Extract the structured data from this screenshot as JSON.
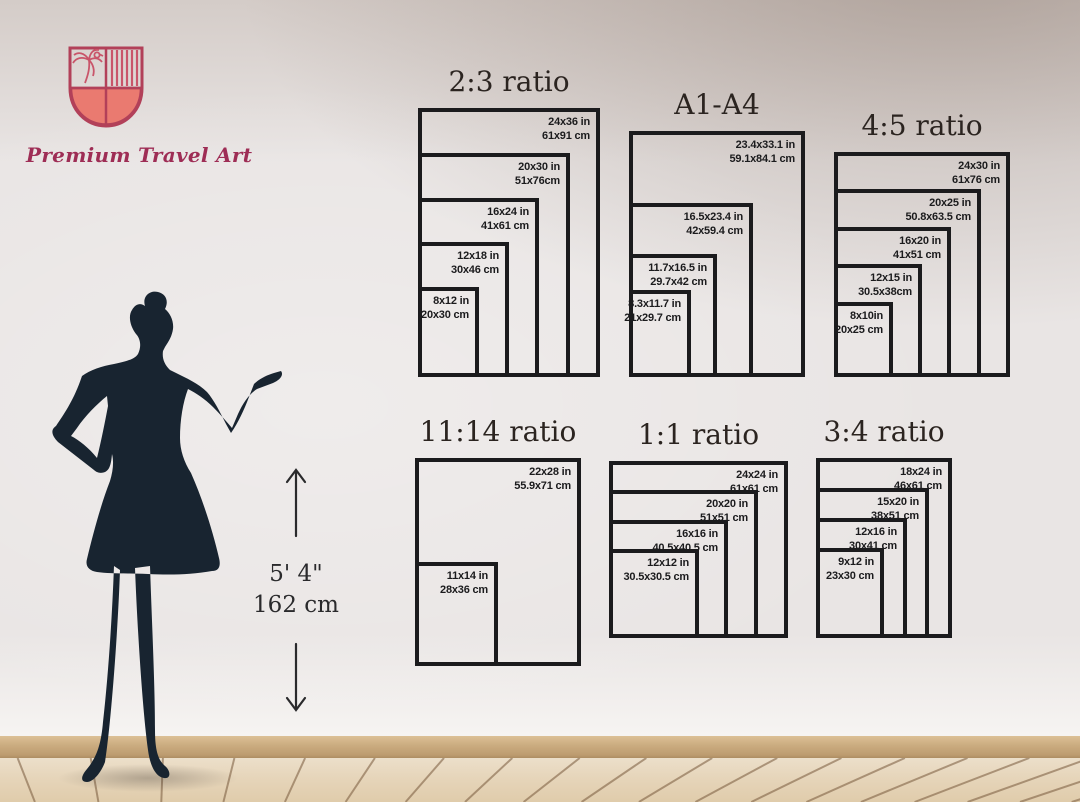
{
  "brand": {
    "name": "Premium Travel Art"
  },
  "height_indicator": {
    "feet": "5' 4\"",
    "cm": "162 cm"
  },
  "charts": [
    {
      "title": "2:3 ratio",
      "sizes": [
        {
          "w": 24,
          "h": 36,
          "in": "24x36 in",
          "cm": "61x91 cm"
        },
        {
          "w": 20,
          "h": 30,
          "in": "20x30 in",
          "cm": "51x76cm"
        },
        {
          "w": 16,
          "h": 24,
          "in": "16x24 in",
          "cm": "41x61 cm"
        },
        {
          "w": 12,
          "h": 18,
          "in": "12x18 in",
          "cm": "30x46 cm"
        },
        {
          "w": 8,
          "h": 12,
          "in": "8x12 in",
          "cm": "20x30 cm"
        }
      ]
    },
    {
      "title": "A1-A4",
      "sizes": [
        {
          "w": 23.4,
          "h": 33.1,
          "in": "23.4x33.1 in",
          "cm": "59.1x84.1 cm"
        },
        {
          "w": 16.5,
          "h": 23.4,
          "in": "16.5x23.4 in",
          "cm": "42x59.4 cm"
        },
        {
          "w": 11.7,
          "h": 16.5,
          "in": "11.7x16.5 in",
          "cm": "29.7x42 cm"
        },
        {
          "w": 8.3,
          "h": 11.7,
          "in": "8.3x11.7 in",
          "cm": "21x29.7 cm"
        }
      ]
    },
    {
      "title": "4:5 ratio",
      "sizes": [
        {
          "w": 24,
          "h": 30,
          "in": "24x30 in",
          "cm": "61x76 cm"
        },
        {
          "w": 20,
          "h": 25,
          "in": "20x25 in",
          "cm": "50.8x63.5 cm"
        },
        {
          "w": 16,
          "h": 20,
          "in": "16x20 in",
          "cm": "41x51 cm"
        },
        {
          "w": 12,
          "h": 15,
          "in": "12x15 in",
          "cm": "30.5x38cm"
        },
        {
          "w": 8,
          "h": 10,
          "in": "8x10in",
          "cm": "20x25 cm"
        }
      ]
    },
    {
      "title": "11:14 ratio",
      "sizes": [
        {
          "w": 22,
          "h": 28,
          "in": "22x28 in",
          "cm": "55.9x71 cm"
        },
        {
          "w": 11,
          "h": 14,
          "in": "11x14 in",
          "cm": "28x36 cm"
        }
      ]
    },
    {
      "title": "1:1 ratio",
      "sizes": [
        {
          "w": 24,
          "h": 24,
          "in": "24x24 in",
          "cm": "61x61 cm"
        },
        {
          "w": 20,
          "h": 20,
          "in": "20x20 in",
          "cm": "51x51 cm"
        },
        {
          "w": 16,
          "h": 16,
          "in": "16x16 in",
          "cm": "40.5x40.5 cm"
        },
        {
          "w": 12,
          "h": 12,
          "in": "12x12 in",
          "cm": "30.5x30.5 cm"
        }
      ]
    },
    {
      "title": "3:4 ratio",
      "sizes": [
        {
          "w": 18,
          "h": 24,
          "in": "18x24 in",
          "cm": "46x61 cm"
        },
        {
          "w": 15,
          "h": 20,
          "in": "15x20 in",
          "cm": "38x51 cm"
        },
        {
          "w": 12,
          "h": 16,
          "in": "12x16 in",
          "cm": "30x41 cm"
        },
        {
          "w": 9,
          "h": 12,
          "in": "9x12 in",
          "cm": "23x30 cm"
        }
      ]
    }
  ],
  "colors": {
    "shield_fill": "#ea7a70",
    "shield_outline": "#b24059",
    "brand_text": "#9e2d55",
    "silhouette": "#182430",
    "chart_stroke": "#1b1b1d"
  }
}
